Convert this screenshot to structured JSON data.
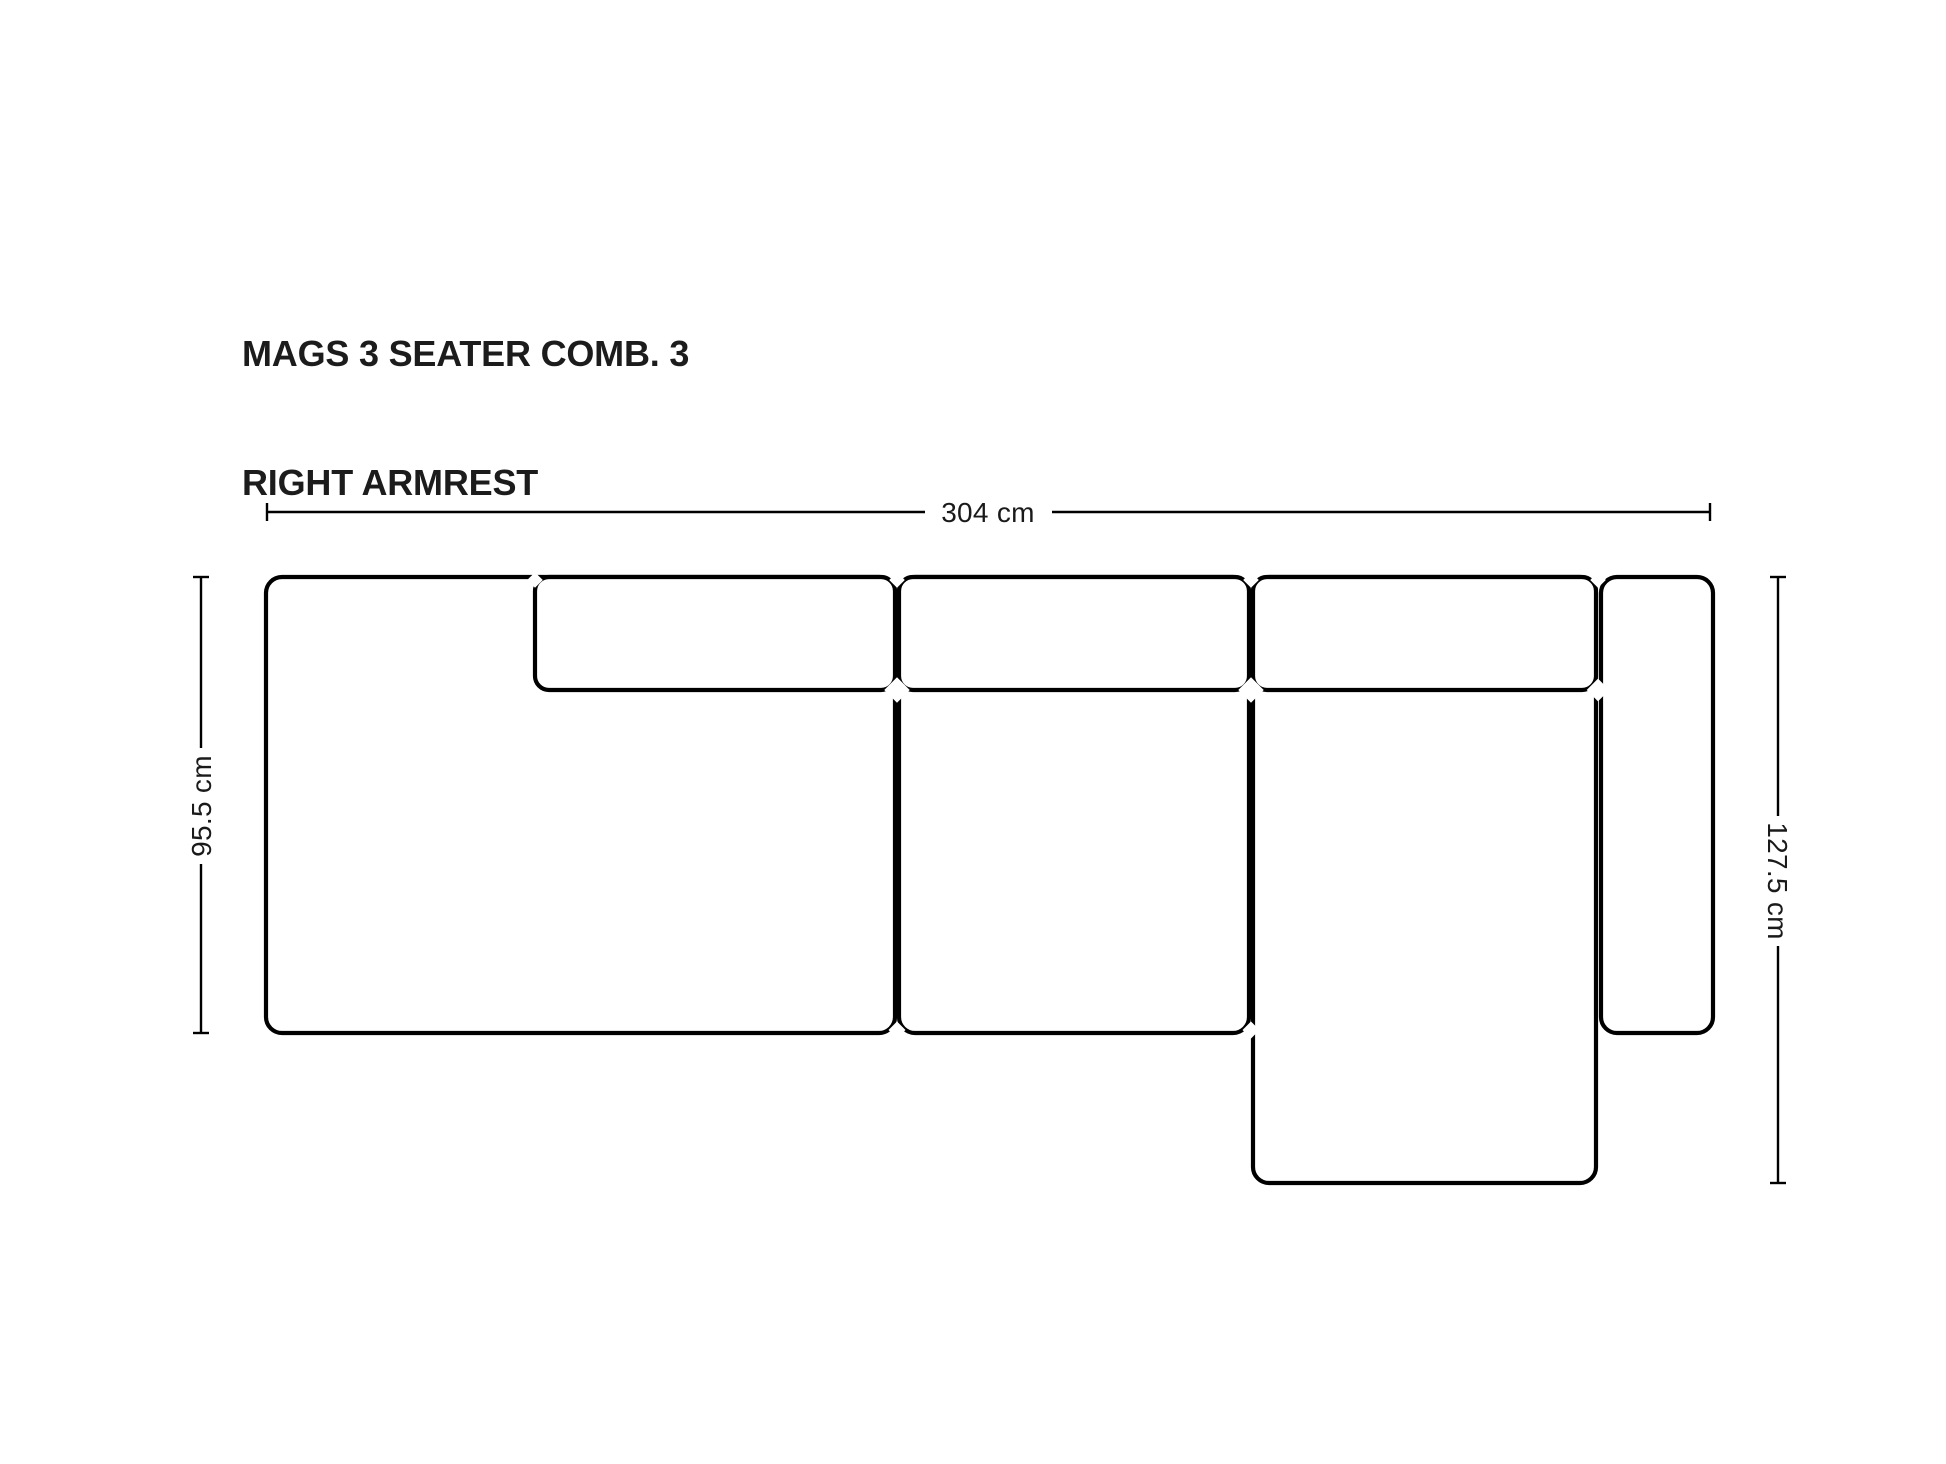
{
  "title": {
    "line1": "MAGS 3 SEATER COMB. 3",
    "line2": "RIGHT ARMREST"
  },
  "dimensions": {
    "overall_width": {
      "label": "304 cm"
    },
    "seat_depth_left": {
      "label": "95.5 cm"
    },
    "chaise_depth_right": {
      "label": "127.5 cm"
    }
  },
  "diagram_parts": [
    "left-armrest-module",
    "back-cushion-left",
    "back-cushion-middle",
    "back-cushion-right",
    "middle-seat-module",
    "chaise-module",
    "right-armrest"
  ],
  "colors": {
    "background": "#ffffff",
    "outline": "#000000",
    "text": "#1c1c1c"
  }
}
